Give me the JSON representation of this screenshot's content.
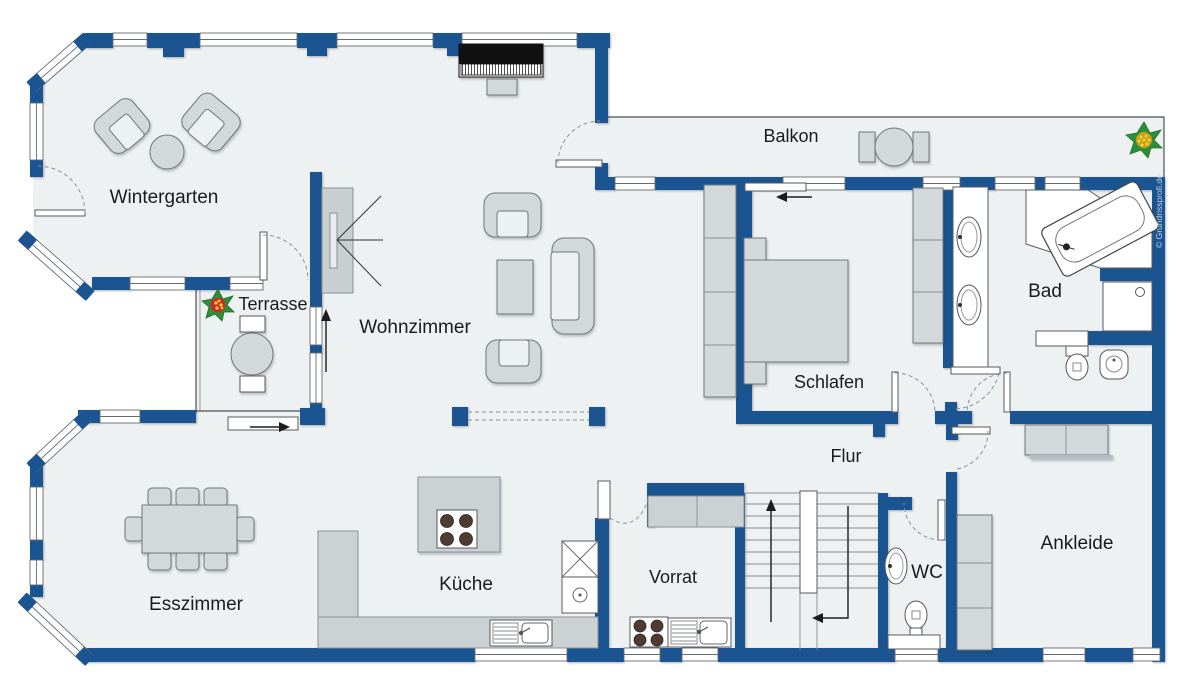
{
  "title": "Grundriss Wohnung",
  "rooms": {
    "wintergarten": {
      "label": "Wintergarten"
    },
    "terrasse": {
      "label": "Terrasse"
    },
    "wohnzimmer": {
      "label": "Wohnzimmer"
    },
    "esszimmer": {
      "label": "Esszimmer"
    },
    "kueche": {
      "label": "Küche"
    },
    "vorrat": {
      "label": "Vorrat"
    },
    "balkon": {
      "label": "Balkon"
    },
    "schlafen": {
      "label": "Schlafen"
    },
    "flur": {
      "label": "Flur"
    },
    "bad": {
      "label": "Bad"
    },
    "wc": {
      "label": "WC"
    },
    "ankleide": {
      "label": "Ankleide"
    }
  },
  "watermark": "© Grundrissprofi.de",
  "colors": {
    "wall": "#1a5592",
    "floor": "#eef1f2",
    "furniture": "#d3d8da",
    "piano": "#111111",
    "plant_green": "#2e8f3a",
    "plant_yellow": "#e8c520",
    "plant_red": "#cc2b2b"
  },
  "icons": {
    "plant_terrace": "plant-icon",
    "plant_balcony": "plant-icon",
    "stairs": "stairs-up-icon"
  }
}
